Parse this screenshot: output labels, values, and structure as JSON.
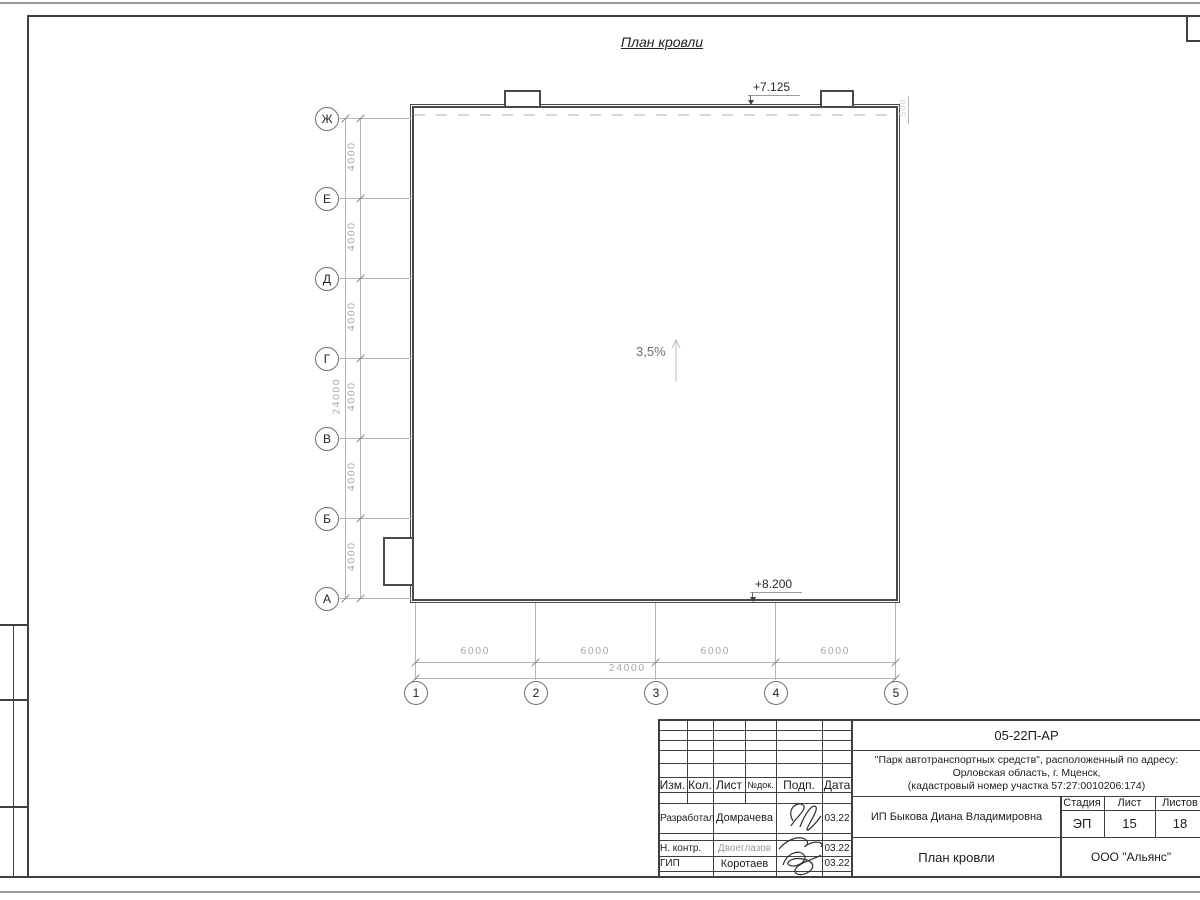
{
  "page": {
    "title": "План кровли"
  },
  "drawing": {
    "elev_top": "+7.125",
    "elev_bottom": "+8.200",
    "slope": "3,5%",
    "small_dim": "500",
    "axes_rows": [
      "Ж",
      "Е",
      "Д",
      "Г",
      "В",
      "Б",
      "А"
    ],
    "axes_cols": [
      "1",
      "2",
      "3",
      "4",
      "5"
    ],
    "dims_left": [
      "4000",
      "4000",
      "4000",
      "4000",
      "4000",
      "4000"
    ],
    "dim_left_total": "24000",
    "dims_bottom": [
      "6000",
      "6000",
      "6000",
      "6000"
    ],
    "dim_bottom_total": "24000"
  },
  "titleblock": {
    "doc_number": "05-22П-АР",
    "project_line1": "\"Парк автотранспортных средств\",  расположенный по адресу:",
    "project_line2": "Орловская область, г. Мценск,",
    "project_line3": "(кадастровый номер участка 57:27:0010206:174)",
    "client": "ИП Быкова Диана Владимировна",
    "sheet_title": "План кровли",
    "company": "ООО \"Альянс\"",
    "cols": {
      "izm": "Изм.",
      "kol": "Кол.",
      "list": "Лист",
      "ndoc": "№док.",
      "podp": "Подп.",
      "data": "Дата"
    },
    "stage_label": "Стадия",
    "sheet_label": "Лист",
    "sheets_label": "Листов",
    "stage": "ЭП",
    "sheet": "15",
    "sheets": "18",
    "rows": [
      {
        "role": "Разработал",
        "name": "Домрачева",
        "date": "03.22"
      },
      {
        "role": "Н. контр.",
        "name": "Двоеглазов",
        "date": "03.22"
      },
      {
        "role": "ГИП",
        "name": "Коротаев",
        "date": "03.22"
      }
    ]
  }
}
